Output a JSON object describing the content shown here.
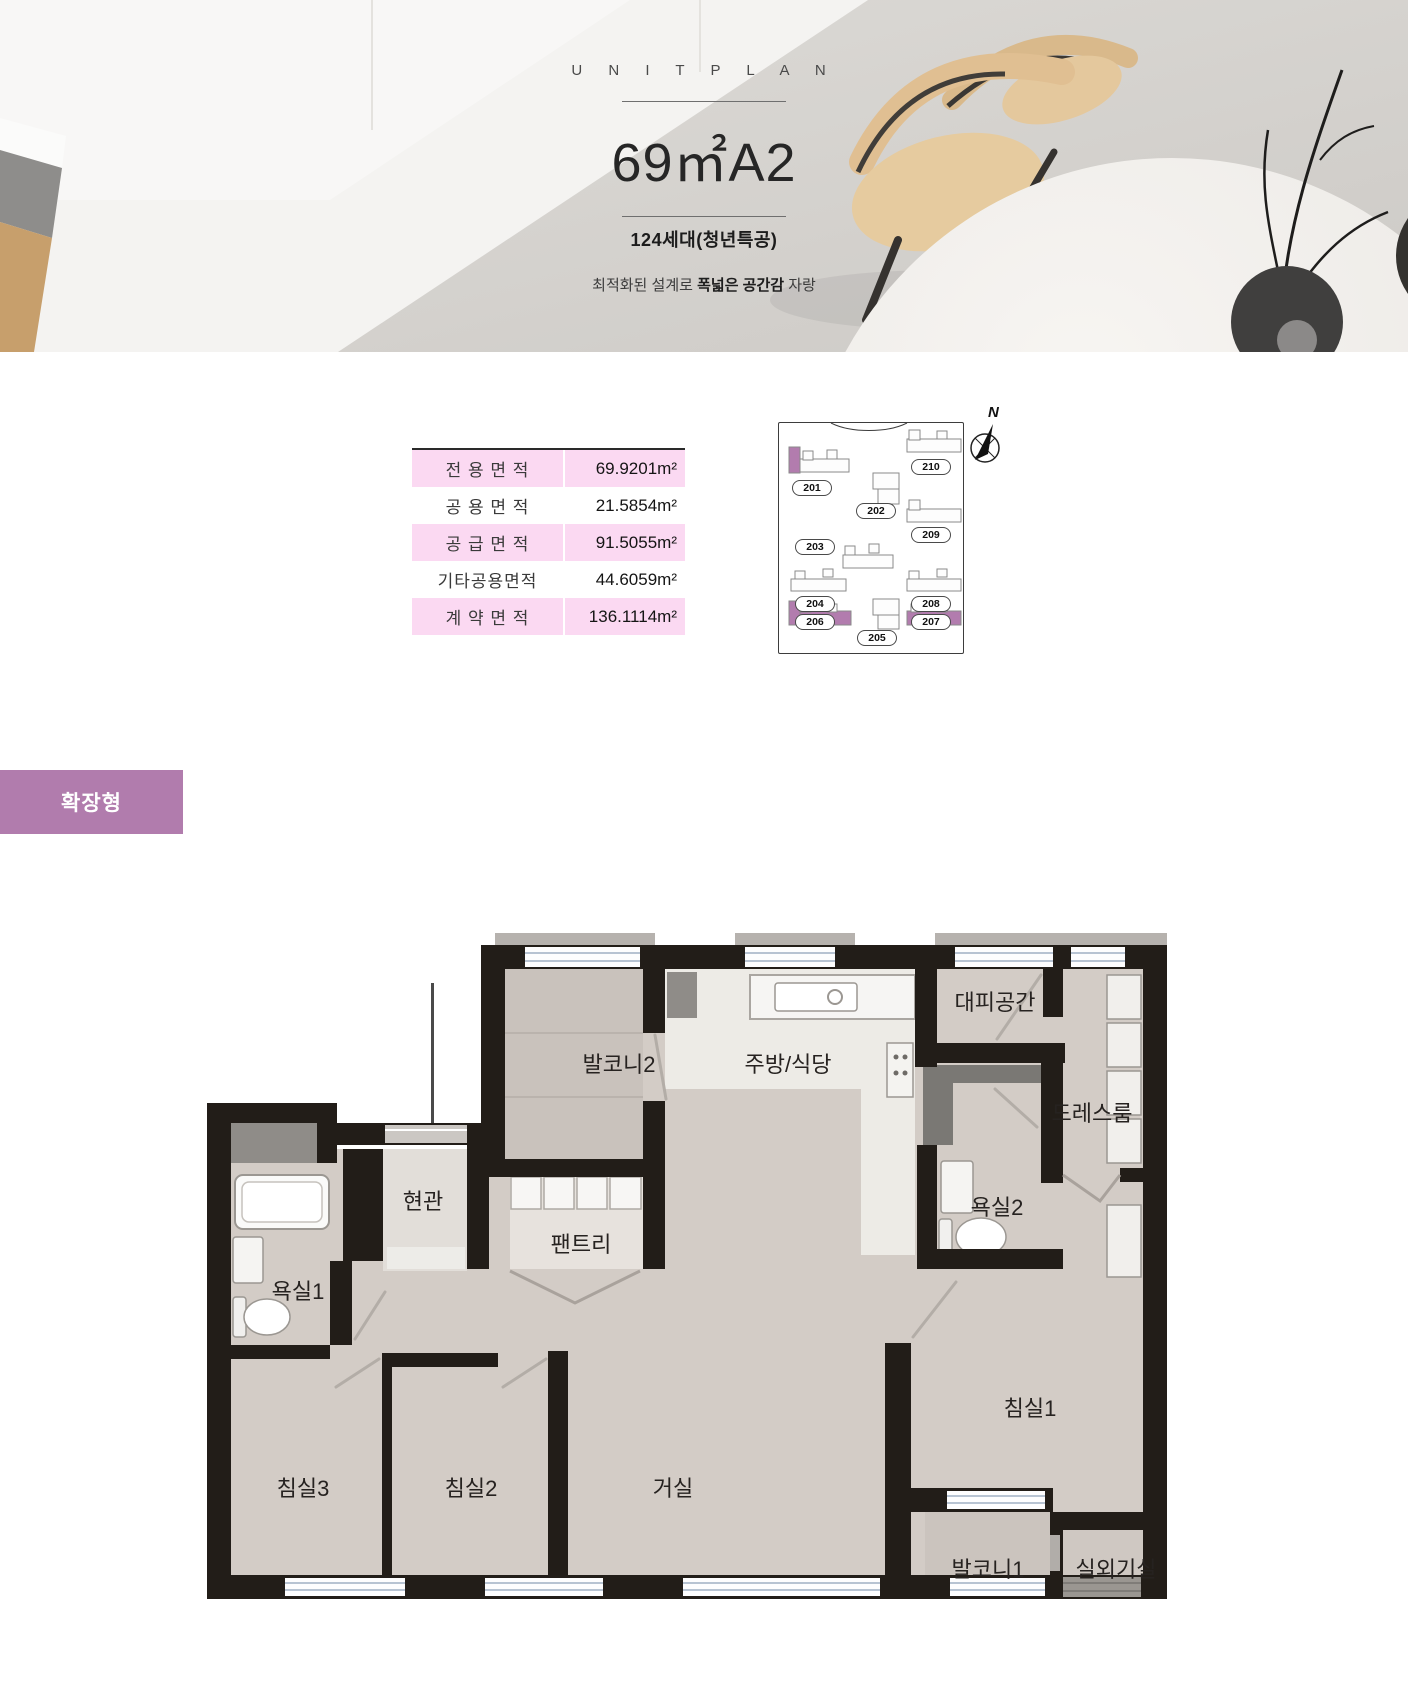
{
  "hero": {
    "eyebrow": "U N I T   P L A N",
    "title": "69㎡A2",
    "units_badge": "124세대(청년특공)",
    "tagline_prefix": "최적화된 설계로 ",
    "tagline_bold": "폭넓은 공간감",
    "tagline_suffix": " 자랑"
  },
  "area_table": {
    "rows": [
      {
        "label": "전 용 면 적",
        "value": "69.9201m²"
      },
      {
        "label": "공 용 면 적",
        "value": "21.5854m²"
      },
      {
        "label": "공 급 면 적",
        "value": "91.5055m²"
      },
      {
        "label": "기타공용면적",
        "value": "44.6059m²"
      },
      {
        "label": "계 약 면 적",
        "value": "136.1114m²"
      }
    ]
  },
  "site_plan": {
    "compass_label": "N",
    "highlight_color": "#b27cae",
    "buildings": [
      {
        "label": "201"
      },
      {
        "label": "202"
      },
      {
        "label": "203"
      },
      {
        "label": "204"
      },
      {
        "label": "205"
      },
      {
        "label": "206"
      },
      {
        "label": "207"
      },
      {
        "label": "208"
      },
      {
        "label": "209"
      },
      {
        "label": "210"
      }
    ]
  },
  "type_badge": "확장형",
  "floor_plan": {
    "rooms": [
      {
        "id": "balcony2",
        "label": "발코니2"
      },
      {
        "id": "kitchen",
        "label": "주방/식당"
      },
      {
        "id": "refuge",
        "label": "대피공간"
      },
      {
        "id": "dressroom",
        "label": "드레스룸"
      },
      {
        "id": "bath2",
        "label": "욕실2"
      },
      {
        "id": "entrance",
        "label": "현관"
      },
      {
        "id": "pantry",
        "label": "팬트리"
      },
      {
        "id": "bath1",
        "label": "욕실1"
      },
      {
        "id": "bedroom3",
        "label": "침실3"
      },
      {
        "id": "bedroom2",
        "label": "침실2"
      },
      {
        "id": "living",
        "label": "거실"
      },
      {
        "id": "bedroom1",
        "label": "침실1"
      },
      {
        "id": "balcony1",
        "label": "발코니1"
      },
      {
        "id": "outdoor-unit",
        "label": "실외기실"
      }
    ]
  }
}
